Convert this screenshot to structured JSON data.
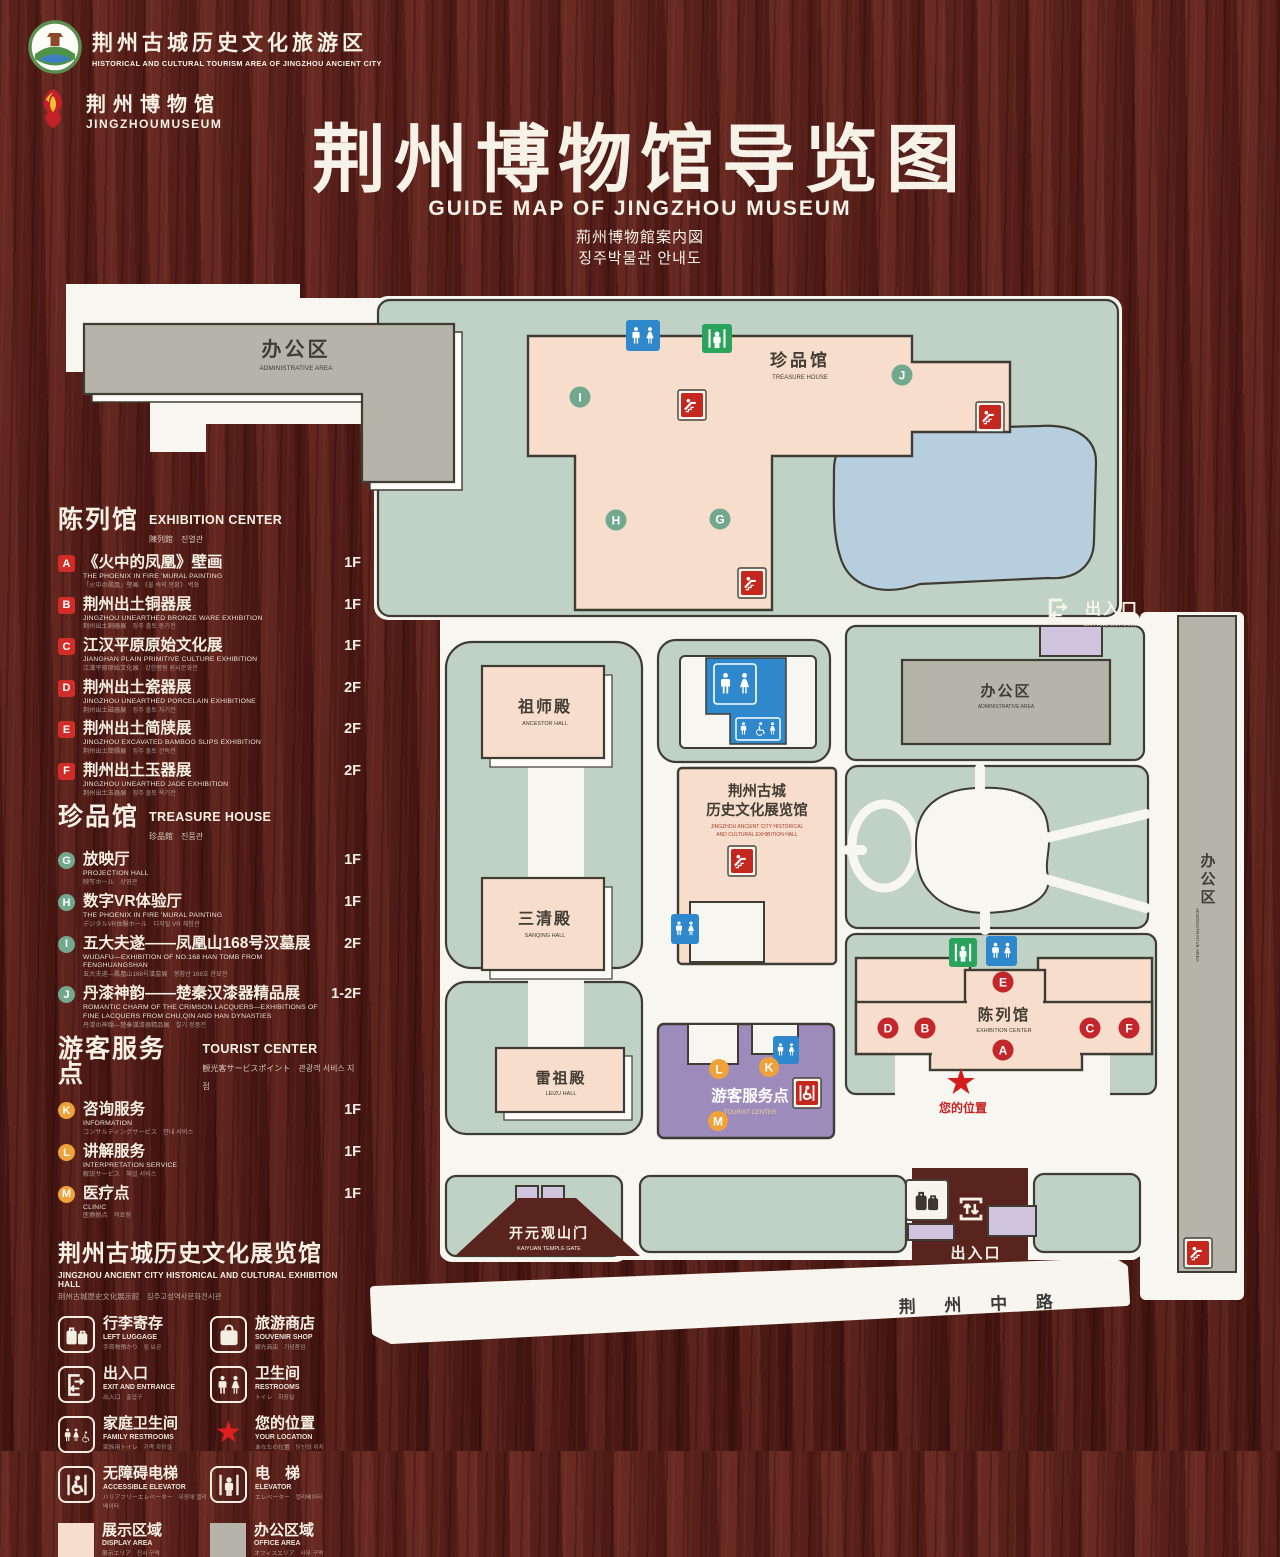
{
  "header": {
    "tourism_logo_title": "荆州古城历史文化旅游区",
    "tourism_logo_subtitle": "HISTORICAL AND CULTURAL TOURISM AREA OF JINGZHOU ANCIENT CITY",
    "museum_logo_title": "荆州博物馆",
    "museum_logo_subtitle": "JINGZHOUMUSEUM",
    "title": "荆州博物馆导览图",
    "subtitle_en": "GUIDE MAP OF JINGZHOU MUSEUM",
    "subtitle_ja": "荊州博物館案内図",
    "subtitle_ko": "징주박물관 안내도"
  },
  "legend": {
    "sections": [
      {
        "title_zh": "陈列馆",
        "title_en": "EXHIBITION CENTER",
        "title_sub": "陳列館　진열관",
        "items": [
          {
            "key": "A",
            "zh": "《火中的凤凰》壁画",
            "en": "THE PHOENIX IN FIRE 'MURAL PAINTING",
            "sub": "「火中の鳳凰」壁画　《불 속의 봉황》 벽화",
            "floor": "1F"
          },
          {
            "key": "B",
            "zh": "荆州出土铜器展",
            "en": "JINGZHOU UNEARTHED BRONZE WARE EXHIBITION",
            "sub": "荆州出土銅器展　징주 출토 동기전",
            "floor": "1F"
          },
          {
            "key": "C",
            "zh": "江汉平原原始文化展",
            "en": "JIANGHAN PLAIN PRIMITIVE CULTURE EXHIBITION",
            "sub": "江漢平原原始文化展　강한평원 원시문화전",
            "floor": "1F"
          },
          {
            "key": "D",
            "zh": "荆州出土瓷器展",
            "en": "JINGZHOU UNEARTHED PORCELAIN EXHIBITIONE",
            "sub": "荆州出土磁器展　징주 출토 자기전",
            "floor": "2F"
          },
          {
            "key": "E",
            "zh": "荆州出土简牍展",
            "en": "JINGZHOU EXCAVATED BAMBOO SLIPS EXHIBITION",
            "sub": "荆州出土簡牘展　징주 출토 간독전",
            "floor": "2F"
          },
          {
            "key": "F",
            "zh": "荆州出土玉器展",
            "en": "JINGZHOU UNEARTHED JADE EXHIBITION",
            "sub": "荆州出土玉器展　징주 출토 옥기전",
            "floor": "2F"
          }
        ]
      },
      {
        "title_zh": "珍品馆",
        "title_en": "TREASURE HOUSE",
        "title_sub": "珍品館　진품관",
        "items": [
          {
            "key": "G",
            "zh": "放映厅",
            "en": "PROJECTION HALL",
            "sub": "映写ホール　상영관",
            "floor": "1F"
          },
          {
            "key": "H",
            "zh": "数字VR体验厅",
            "en": "THE PHOENIX IN FIRE 'MURAL PAINTING",
            "sub": "デジタルVR体験ホール　디지털 VR 체험관",
            "floor": "1F"
          },
          {
            "key": "I",
            "zh": "五大夫遂——凤凰山168号汉墓展",
            "en": "WUDAFU—EXHIBITION OF NO.168 HAN TOMB FROM FENGHUANGSHAN",
            "sub": "五大夫遂—鳳凰山168号漢墓展　봉황산 168호 한묘전",
            "floor": "2F"
          },
          {
            "key": "J",
            "zh": "丹漆神韵——楚秦汉漆器精品展",
            "en": "ROMANTIC CHARM OF THE CRIMSON LACQUERS—EXHIBITIONS OF FINE LACQUERS FROM CHU,QIN AND HAN DYNASTIES",
            "sub": "丹漆の神韻—楚秦漢漆器精品展　칠기 정품전",
            "floor": "1-2F"
          }
        ]
      },
      {
        "title_zh": "游客服务点",
        "title_en": "TOURIST CENTER",
        "title_sub": "観光客サービスポイント　관광객 서비스 지점",
        "items": [
          {
            "key": "K",
            "zh": "咨询服务",
            "en": "INFORMATION",
            "sub": "コンサルティングサービス　안내 서비스",
            "floor": "1F"
          },
          {
            "key": "L",
            "zh": "讲解服务",
            "en": "INTERPRETATION SERVICE",
            "sub": "解説サービス　해설 서비스",
            "floor": "1F"
          },
          {
            "key": "M",
            "zh": "医疗点",
            "en": "CLINIC",
            "sub": "医療拠点　의료점",
            "floor": "1F"
          }
        ]
      }
    ],
    "hall_note": {
      "zh": "荆州古城历史文化展览馆",
      "en": "JINGZHOU ANCIENT CITY HISTORICAL AND CULTURAL EXHIBITION HALL",
      "sub": "荆州古城歴史文化展示館　징주고성역사문화전시관"
    },
    "icons": [
      {
        "zh": "行李寄存",
        "en": "LEFT LUGGAGE",
        "sub": "手荷物預かり　짐 보관"
      },
      {
        "zh": "旅游商店",
        "en": "SOUVENIR SHOP",
        "sub": "観光商店　기념품점"
      },
      {
        "zh": "出入口",
        "en": "EXIT AND ENTRANCE",
        "sub": "出入口　출입구"
      },
      {
        "zh": "卫生间",
        "en": "RESTROOMS",
        "sub": "トイレ　화장실"
      },
      {
        "zh": "家庭卫生间",
        "en": "FAMILY RESTROOMS",
        "sub": "家族用トイレ　가족 화장실"
      },
      {
        "zh": "您的位置",
        "en": "YOUR LOCATION",
        "sub": "あなたの位置　당신의 위치"
      },
      {
        "zh": "无障碍电梯",
        "en": "ACCESSIBLE ELEVATOR",
        "sub": "バリアフリーエレベーター　무장애 엘리베이터"
      },
      {
        "zh": "电　梯",
        "en": "ELEVATOR",
        "sub": "エレベーター　엘리베이터"
      },
      {
        "zh": "展示区域",
        "en": "DISPLAY AREA",
        "sub": "展示エリア　전시 구역"
      },
      {
        "zh": "办公区域",
        "en": "OFFICE AREA",
        "sub": "オフィスエリア　사무 구역"
      }
    ]
  },
  "map": {
    "labels": {
      "admin_tl_zh": "办公区",
      "admin_tl_en": "ADMINISTRATIVE AREA",
      "treasure_zh": "珍品馆",
      "treasure_en": "TREASURE HOUSE",
      "ancestor_zh": "祖师殿",
      "ancestor_en": "ANCESTOR HALL",
      "sanqing_zh": "三清殿",
      "sanqing_en": "SANQING HALL",
      "leizu_zh": "雷祖殿",
      "leizu_en": "LEIZU HALL",
      "jz_zh1": "荆州古城",
      "jz_zh2": "历史文化展览馆",
      "jz_en1": "JINGZHOU ANCIENT CITY HISTORICAL",
      "jz_en2": "AND CULTURAL EXHIBITION HALL",
      "tourist_zh": "游客服务点",
      "tourist_en": "TOURIST CENTER",
      "exhibition_zh": "陈列馆",
      "exhibition_en": "EXHIBITION CENTER",
      "admin_r_zh": "办公区",
      "admin_r_en": "ADMINISTRATIVE AREA",
      "admin_strip_zh": "办公区",
      "admin_strip_en": "ADMINISTRATIVE AREA",
      "exit_top_zh": "出入口",
      "exit_top_en": "EXIT AND ENTRANCE",
      "exit_bottom_zh": "出入口",
      "exit_bottom_en": "EXIT AND ENTRANCE",
      "kaiyuan_zh": "开元观山门",
      "kaiyuan_en": "KAIYUAN TEMPLE GATE",
      "road": "荆 州 中 路",
      "your_location": "您的位置",
      "star": "★"
    },
    "markers": {
      "I": "I",
      "J": "J",
      "H": "H",
      "G": "G",
      "E": "E",
      "D": "D",
      "B": "B",
      "A": "A",
      "C": "C",
      "F": "F",
      "L": "L",
      "K": "K",
      "M": "M"
    }
  },
  "colors": {
    "display_area": "#f7ddcb",
    "office_area": "#b6b4a9",
    "campus_green": "#bfd2c5",
    "pond_blue": "#b7cede",
    "tourist_purple": "#9d8bbb",
    "badge_red": "#d22c28",
    "badge_green": "#72a98e",
    "badge_orange": "#f0a23a",
    "restroom_blue": "#2f88cc",
    "elevator_green": "#2aa35c",
    "escalator_red": "#c3271d",
    "star_red": "#d31d1d"
  }
}
